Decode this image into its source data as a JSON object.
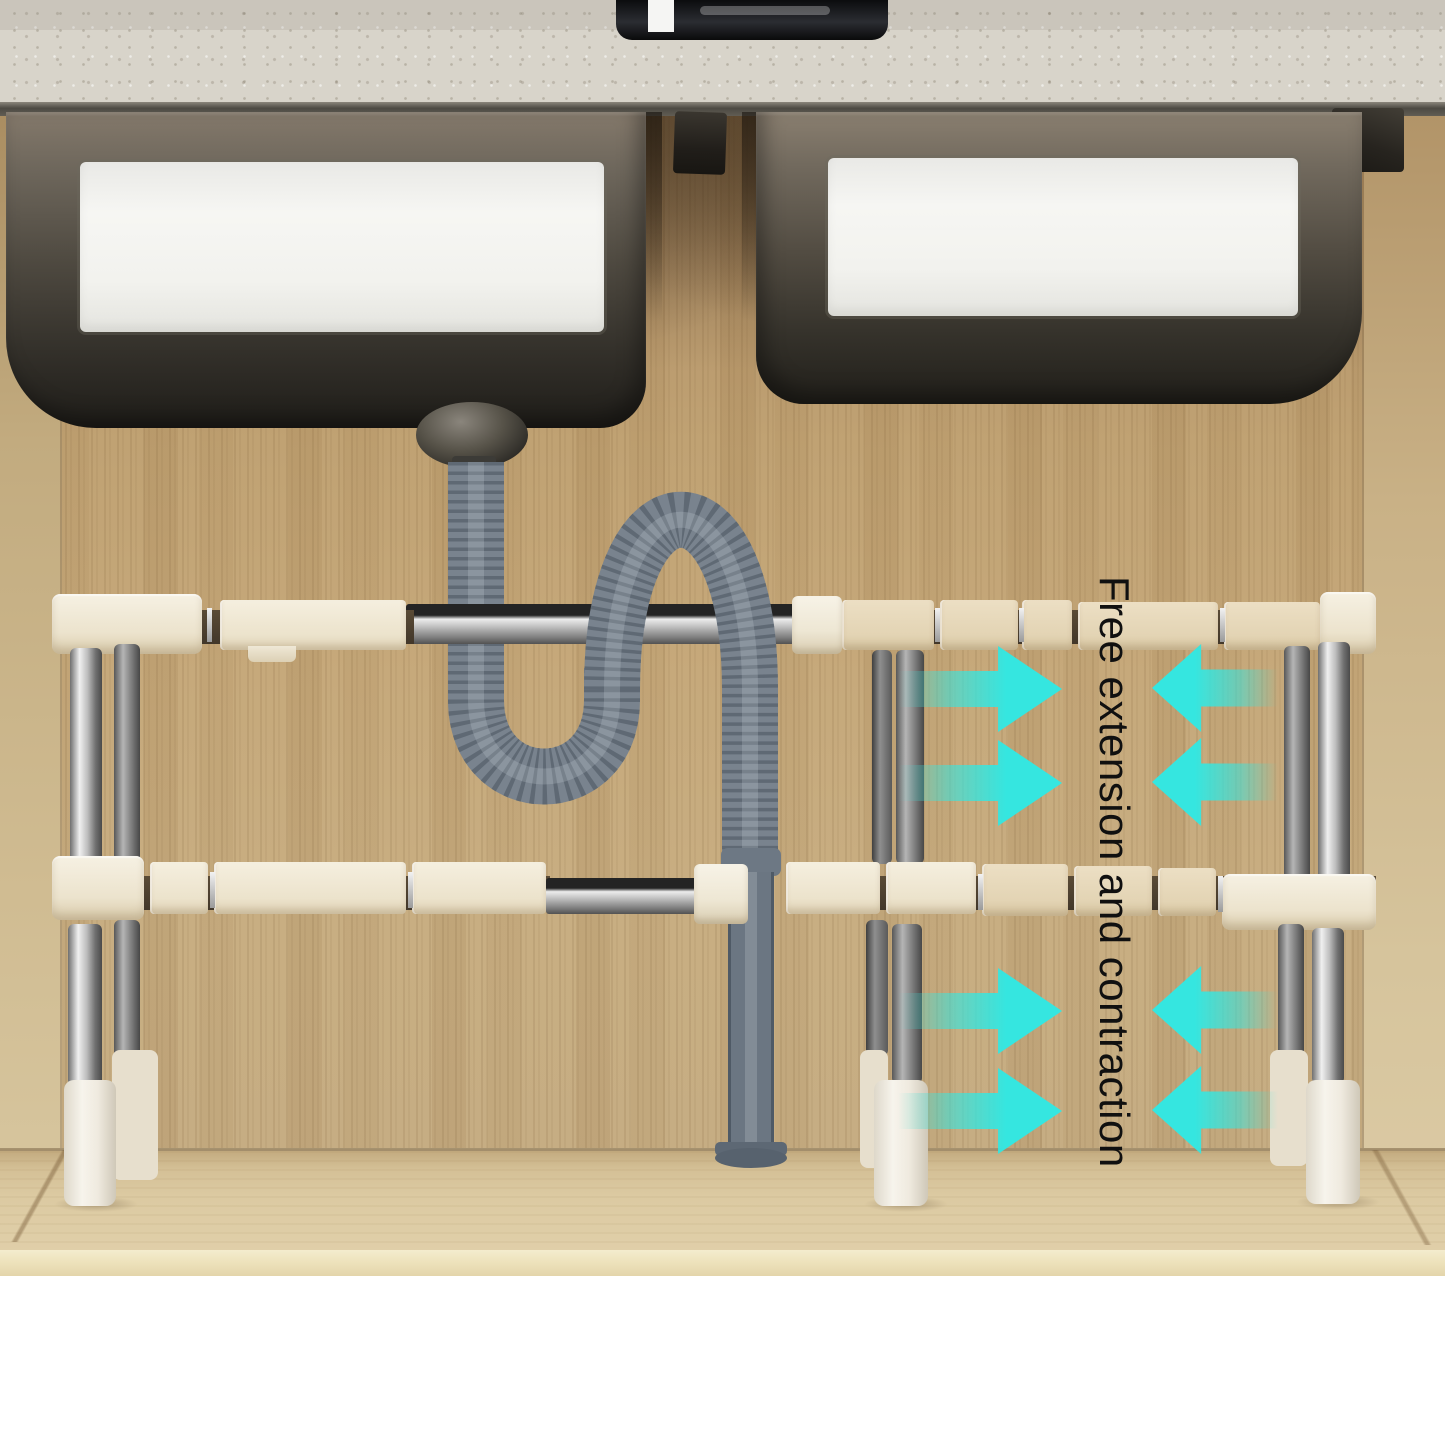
{
  "annotation": {
    "text": "Free extension and contraction",
    "text_color": "#101010",
    "arrow_color": "#35e6e0",
    "arrow_groups": [
      {
        "position": "upper-left",
        "direction": "right",
        "count": 2
      },
      {
        "position": "upper-right",
        "direction": "left",
        "count": 2
      },
      {
        "position": "lower-left",
        "direction": "right",
        "count": 2
      },
      {
        "position": "lower-right",
        "direction": "left",
        "count": 2
      }
    ]
  },
  "scene": {
    "subject": "Two-tier expandable under-sink storage rack beneath a double sink with flexible drain pipe",
    "colors": {
      "cabinet_wood": "#c1a274",
      "cabinet_floor": "#dcc9a2",
      "countertop": "#d7d3c9",
      "drain_pipe": "#77818c",
      "rack_slats": "#efe7d4",
      "rack_chrome": "#c2c2c2",
      "rack_feet": "#f3efe6"
    }
  }
}
